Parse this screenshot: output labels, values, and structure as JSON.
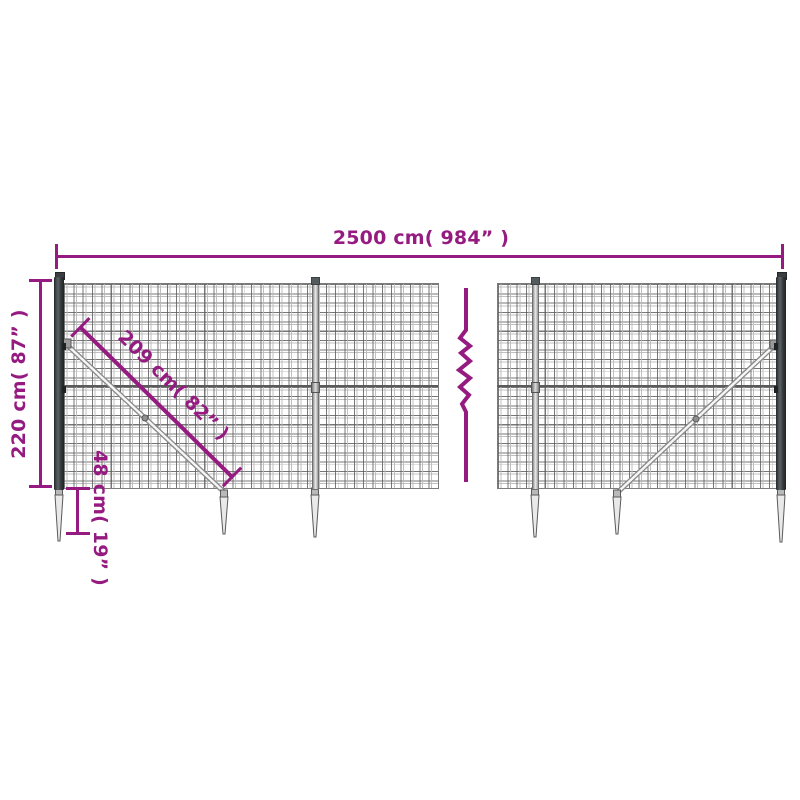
{
  "diagram": {
    "kind": "wire-mesh-fence-dimension-diagram",
    "dimensions": {
      "total_width": {
        "label": "2500 cm( 984” )"
      },
      "total_height": {
        "label": "220 cm( 87” )"
      },
      "diagonal_brace": {
        "label": "209 cm( 82” )"
      },
      "anchor_spike_depth": {
        "label": "48 cm( 19” )"
      }
    },
    "colors": {
      "dimension_accent": "#951B81",
      "post_anthracite": "#3A3E40",
      "mesh_wire": "#8E8E8E",
      "hardware_gray": "#9A9A9A",
      "background": "#FFFFFF"
    },
    "icons": {
      "break_line_icon": "zigzag"
    }
  }
}
